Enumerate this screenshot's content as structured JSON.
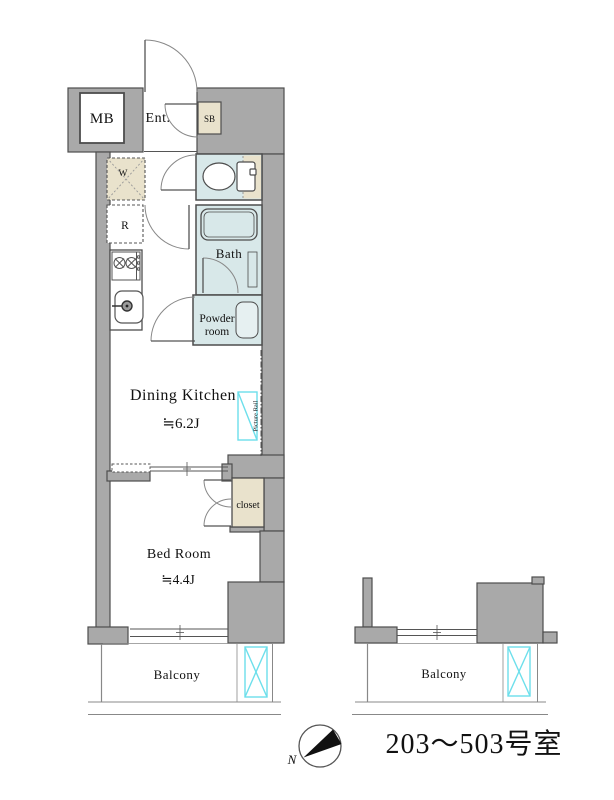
{
  "plan": {
    "unit_label": "203〜503号室",
    "compass": {
      "north_label": "N"
    },
    "colors": {
      "wall_fill": "#a9a9a9",
      "outline": "#4d4d4d",
      "wet_room_fill": "#d8e8e9",
      "storage_fill": "#e9e2cc",
      "accent_cyan": "#6ddfeb"
    },
    "rooms": {
      "meter_box": "MB",
      "entrance": "Ent.",
      "shoe_box": "SB",
      "washer": "W",
      "refrigerator": "R",
      "bath": "Bath",
      "powder_line1": "Powder",
      "powder_line2": "room",
      "dining_kitchen": "Dining Kitchen",
      "dining_size": "≒6.2J",
      "picture_rail": "Picture Rail",
      "closet": "closet",
      "bed_room": "Bed Room",
      "bed_size": "≒4.4J",
      "balcony_left": "Balcony",
      "balcony_right": "Balcony"
    }
  }
}
